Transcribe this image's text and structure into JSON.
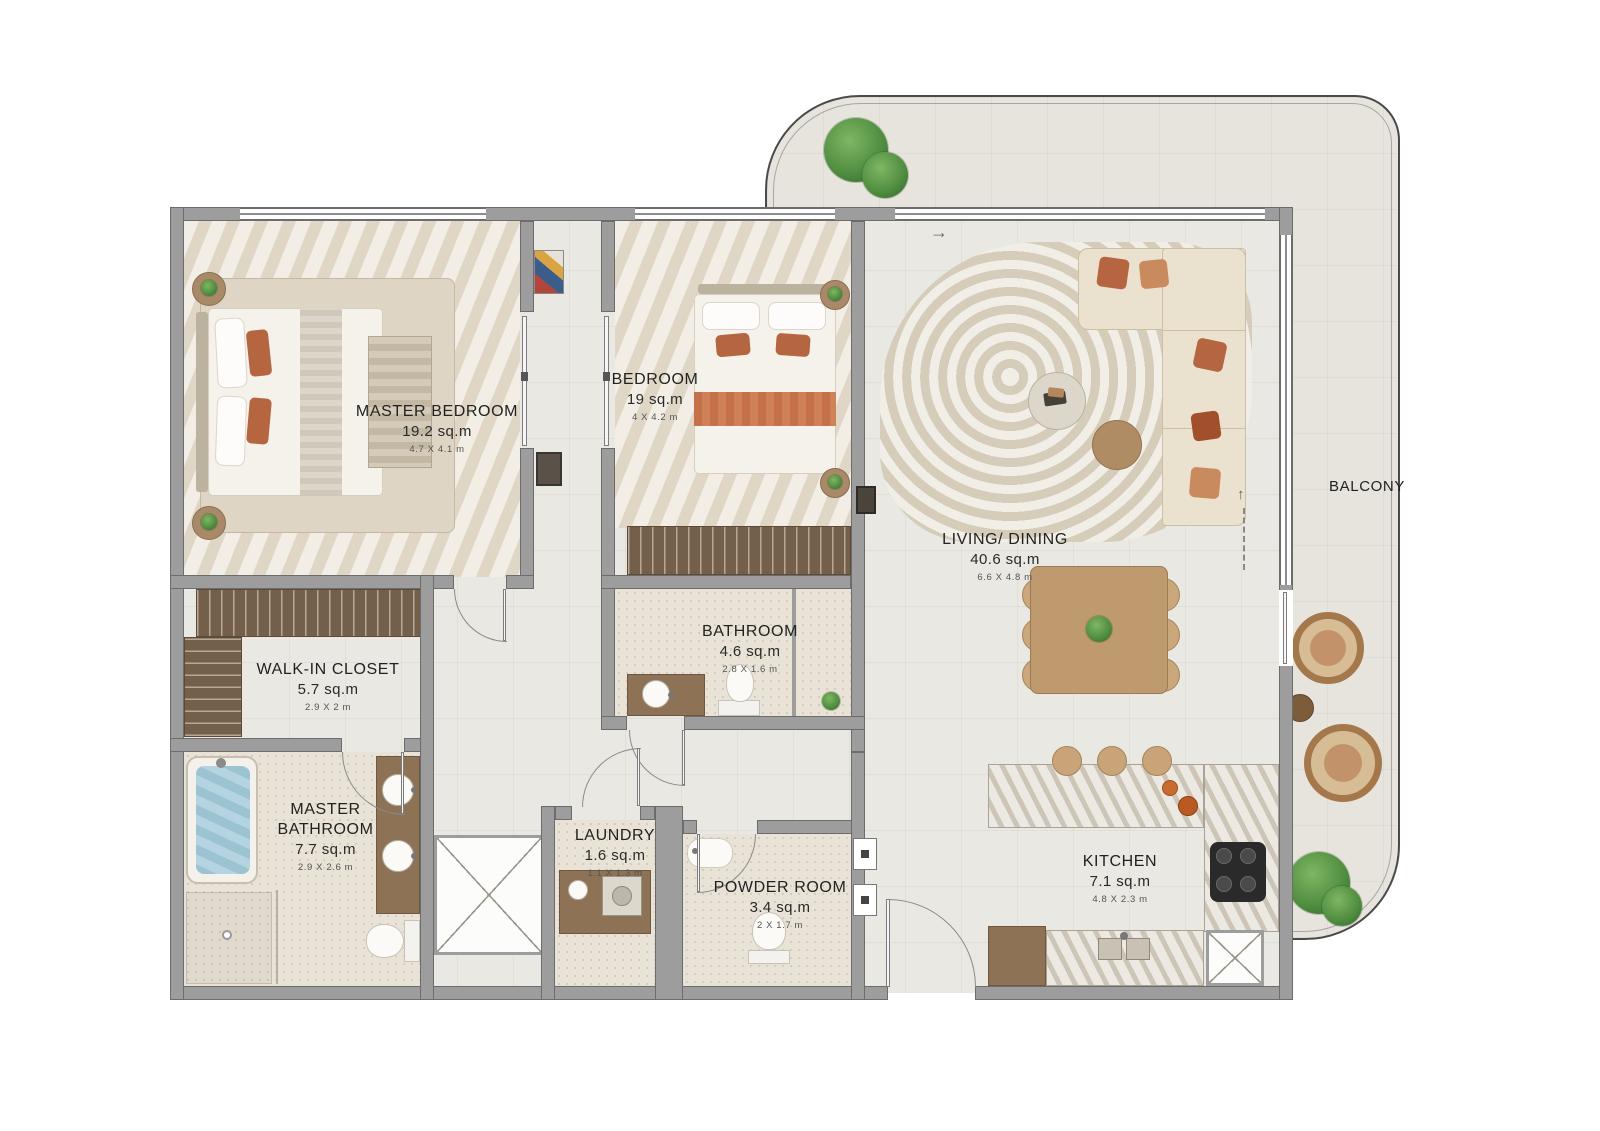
{
  "title": "Apartment Floor Plan",
  "rooms": [
    {
      "id": "master-bedroom",
      "name": "MASTER BEDROOM",
      "area": "19.2 sq.m",
      "dims": "4.7 X 4.1 m"
    },
    {
      "id": "bedroom",
      "name": "BEDROOM",
      "area": "19 sq.m",
      "dims": "4 X 4.2 m"
    },
    {
      "id": "living-dining",
      "name": "LIVING/ DINING",
      "area": "40.6 sq.m",
      "dims": "6.6 X 4.8 m"
    },
    {
      "id": "walk-in-closet",
      "name": "WALK-IN CLOSET",
      "area": "5.7 sq.m",
      "dims": "2.9 X 2 m"
    },
    {
      "id": "bathroom",
      "name": "BATHROOM",
      "area": "4.6 sq.m",
      "dims": "2.8 X 1.6 m"
    },
    {
      "id": "master-bathroom",
      "name": "MASTER BATHROOM",
      "area": "7.7 sq.m",
      "dims": "2.9 X 2.6 m"
    },
    {
      "id": "laundry",
      "name": "LAUNDRY",
      "area": "1.6 sq.m",
      "dims": "1.1 X 1.3 m"
    },
    {
      "id": "powder-room",
      "name": "POWDER ROOM",
      "area": "3.4 sq.m",
      "dims": "2 X 1.7 m"
    },
    {
      "id": "kitchen",
      "name": "KITCHEN",
      "area": "7.1 sq.m",
      "dims": "4.8 X 2.3 m"
    },
    {
      "id": "balcony",
      "name": "BALCONY"
    }
  ],
  "annotations": {
    "entry_arrow": "→",
    "balcony_arrow": "↑"
  },
  "colors": {
    "wall": "#9d9d9d",
    "floor": "#eae8e2",
    "balcony_floor": "#e7e4dd",
    "terracotta": "#b5653f",
    "wood": "#a98a68",
    "water": "#9cc3d2",
    "plant": "#4e8c3f",
    "marble": "#d6d0c4"
  }
}
